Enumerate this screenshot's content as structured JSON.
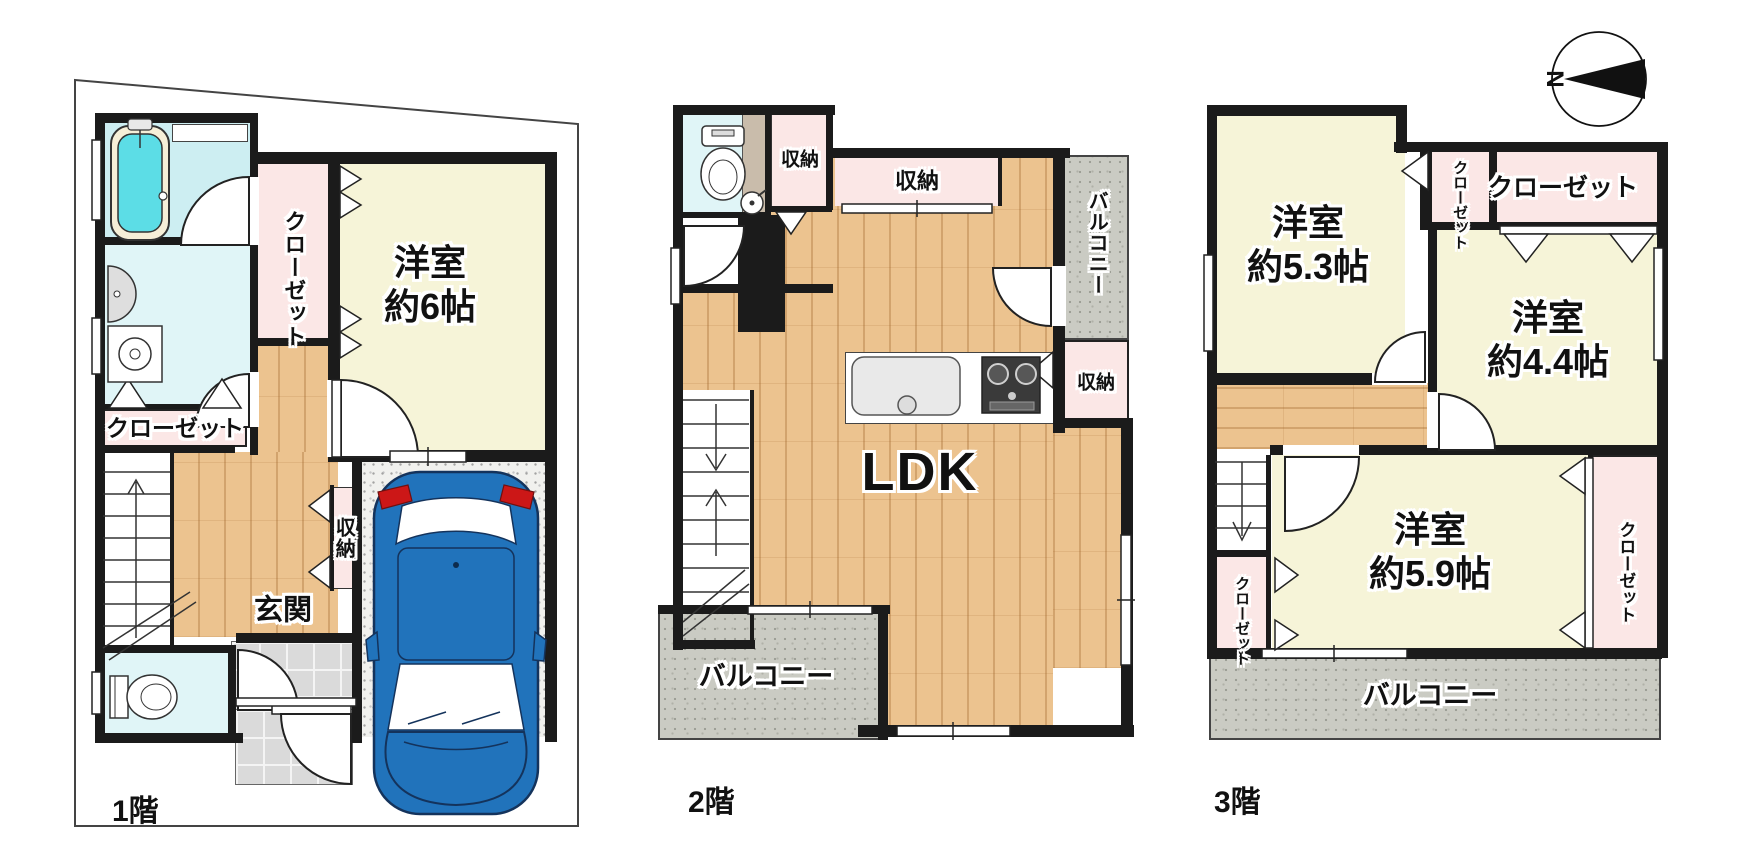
{
  "compass": {
    "north_label": "N"
  },
  "floor1": {
    "floor_label": "1階",
    "closet_upper": "クローゼット",
    "room": {
      "name": "洋室",
      "size": "約6帖"
    },
    "closet_lower": "クローゼット",
    "storage": "収納",
    "entrance": "玄関"
  },
  "floor2": {
    "floor_label": "2階",
    "storage_small": "収納",
    "storage_top": "収納",
    "balcony_side": "バルコニー",
    "storage_side": "収納",
    "ldk": "LDK",
    "balcony_bottom": "バルコニー"
  },
  "floor3": {
    "floor_label": "3階",
    "room_a": {
      "name": "洋室",
      "size": "約5.3帖"
    },
    "closet_a": "クローゼット",
    "closet_b": "クローゼット",
    "room_b": {
      "name": "洋室",
      "size": "約4.4帖"
    },
    "closet_c": "クローゼット",
    "room_c": {
      "name": "洋室",
      "size": "約5.9帖"
    },
    "closet_d": "クローゼット",
    "balcony": "バルコニー"
  },
  "colors": {
    "wall": "#1b1b1b",
    "room_yellow": "#f6f4d8",
    "closet_pink": "#fbe7e6",
    "water_cyan": "#cdeef2",
    "wood_floor": "#ecc38f",
    "balcony_gray": "#cacbc3",
    "car_blue": "#2173bb",
    "bathtub_cyan": "#5cdde6"
  }
}
